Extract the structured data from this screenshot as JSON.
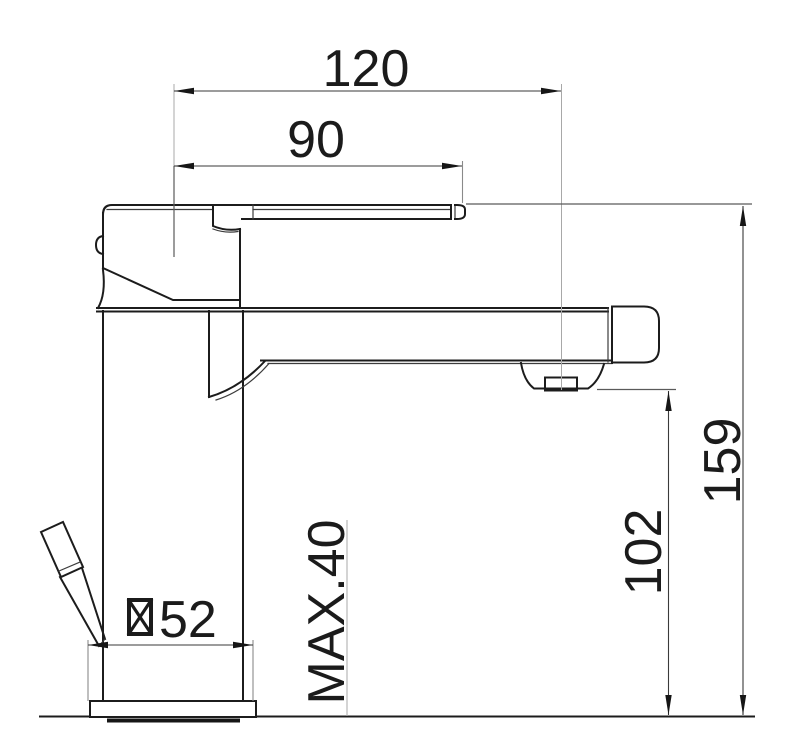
{
  "meta": {
    "title": "Basin mixer tap - dimensioned side elevation",
    "units": "mm"
  },
  "colors": {
    "object_line": "#1c1c1c",
    "dimension_line": "#3a3a3a",
    "extension_line": "#a8a8a8",
    "background": "#ffffff",
    "text": "#1b1b1b"
  },
  "dimensions": {
    "spout_reach": {
      "label": "120",
      "value": 120,
      "orientation": "horizontal"
    },
    "handle_projection": {
      "label": "90",
      "value": 90,
      "orientation": "horizontal"
    },
    "overall_height": {
      "label": "159",
      "value": 159,
      "orientation": "vertical"
    },
    "outlet_height": {
      "label": "102",
      "value": 102,
      "orientation": "vertical"
    },
    "max_deck_thickness": {
      "label": "MAX.40",
      "value": 40,
      "orientation": "vertical"
    },
    "base_width": {
      "label": "52",
      "value": 52,
      "symbol": "square-section",
      "orientation": "horizontal"
    }
  }
}
